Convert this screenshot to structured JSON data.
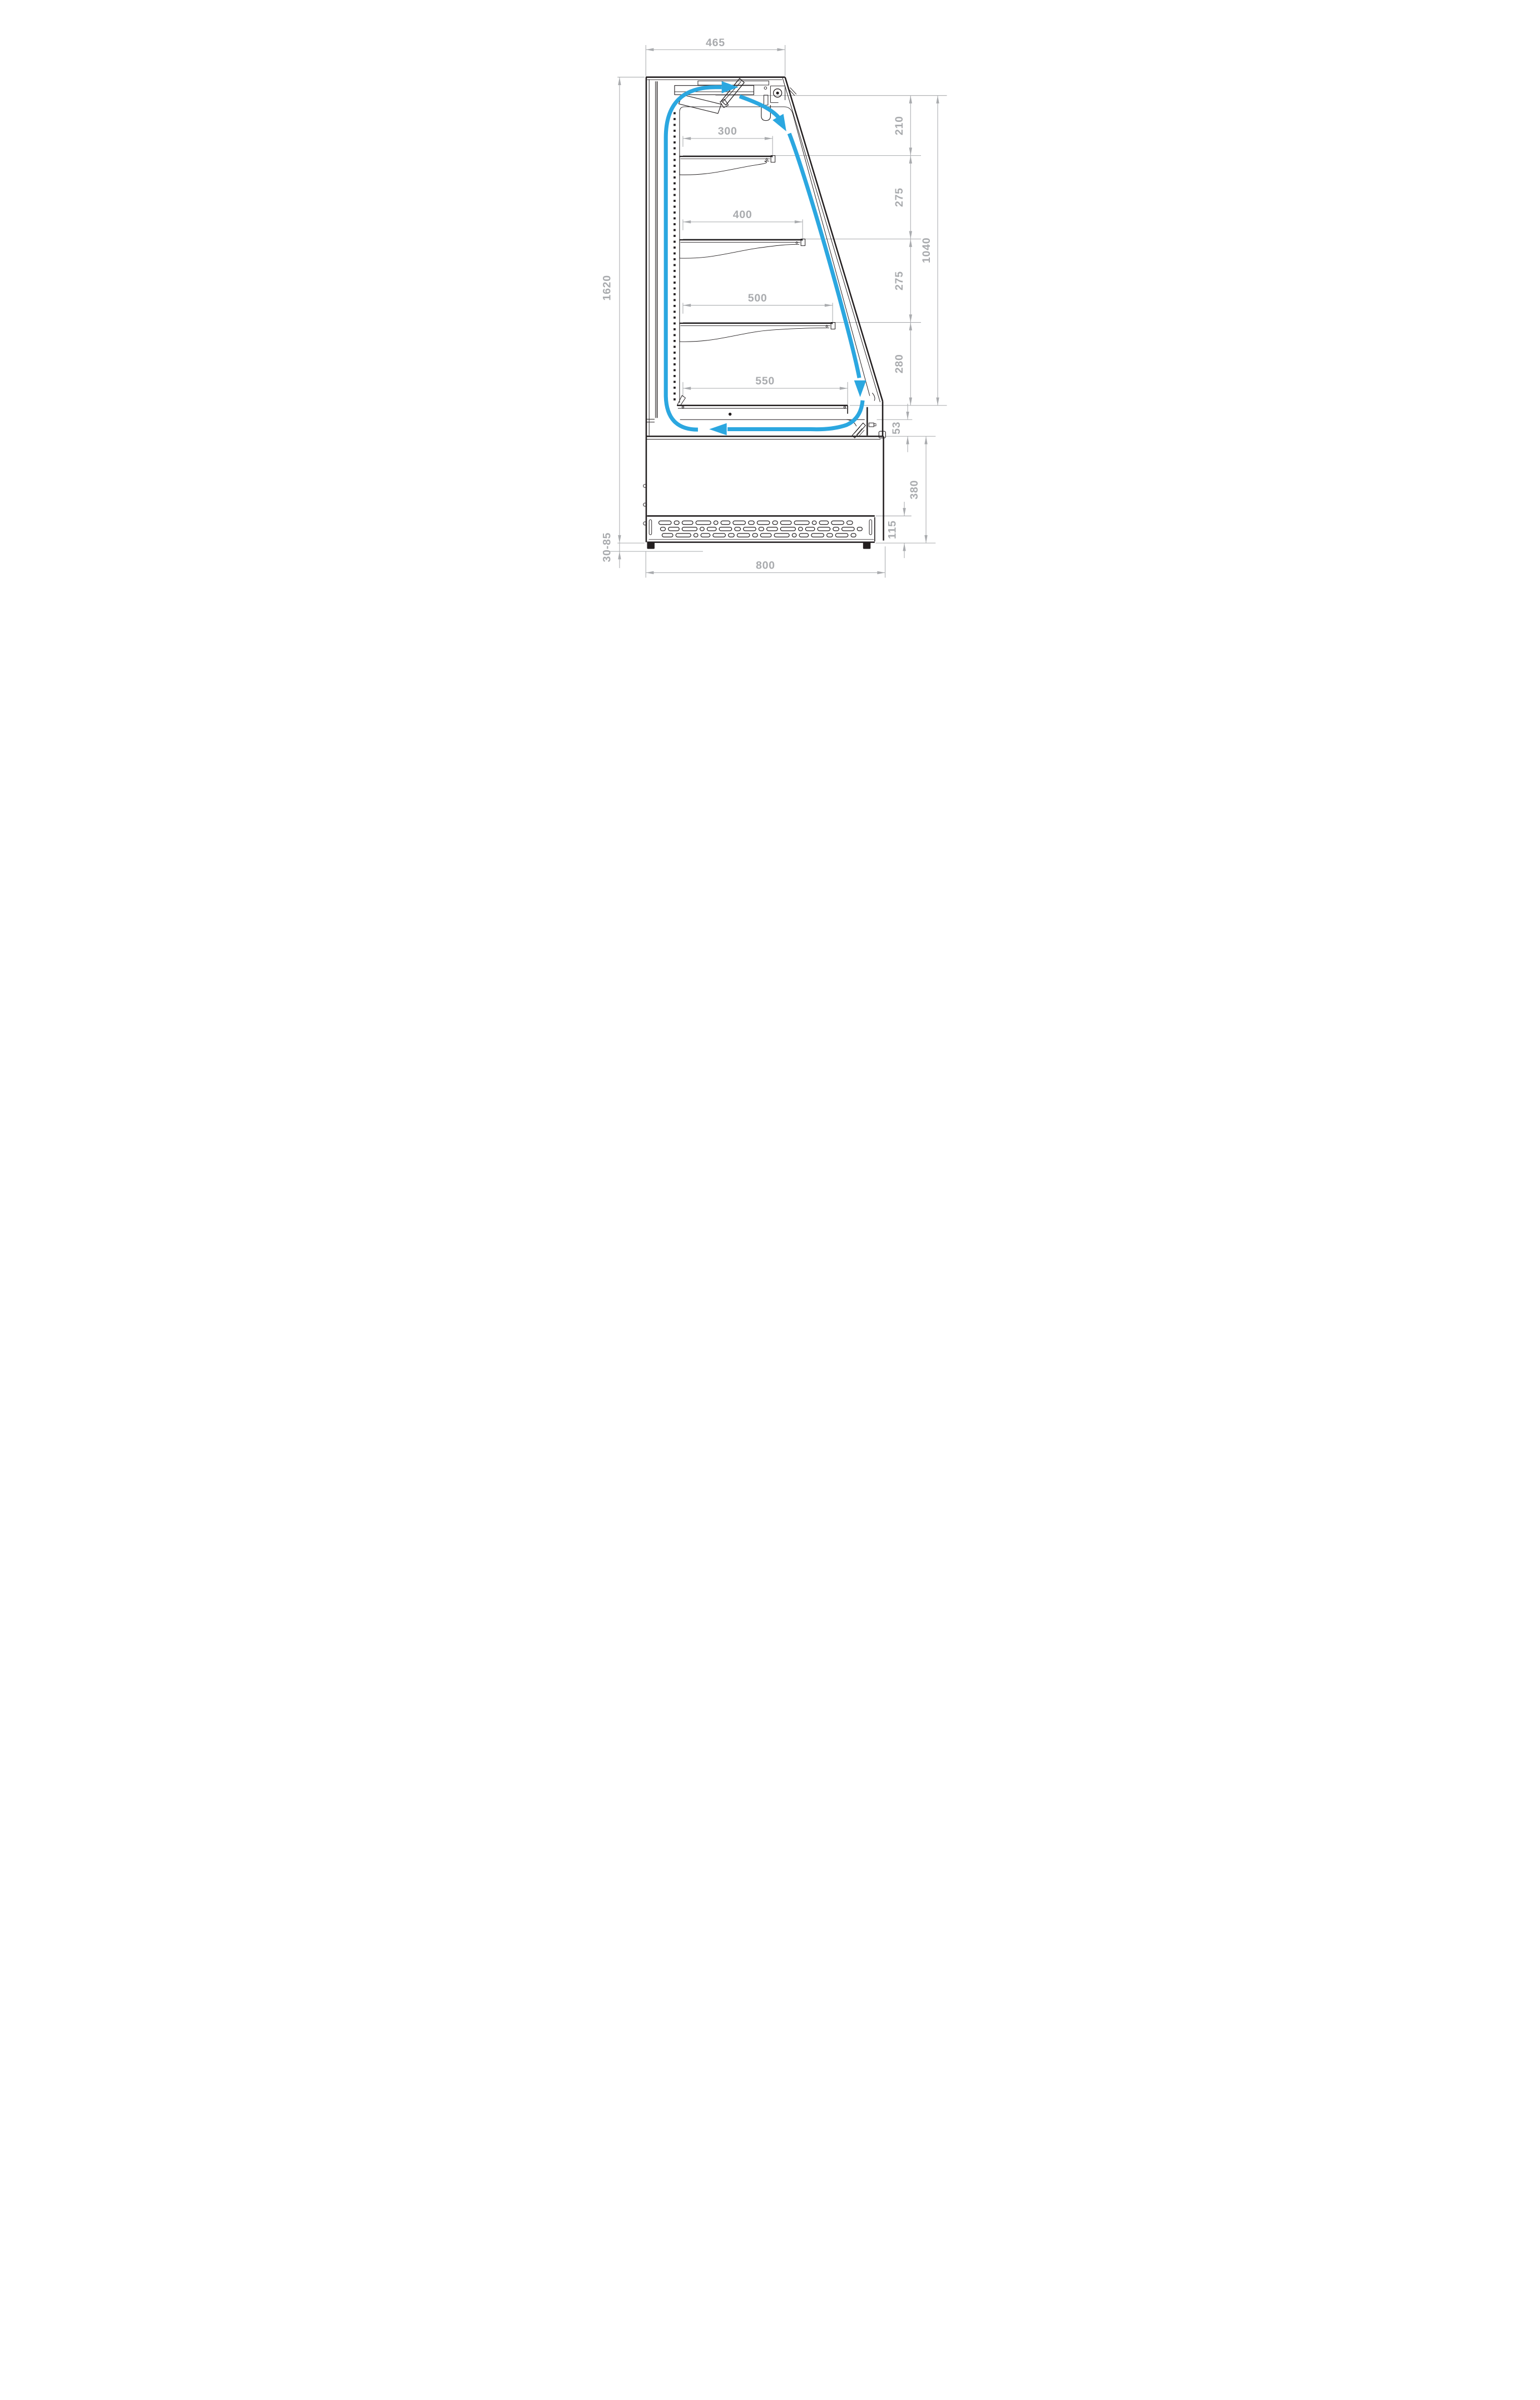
{
  "drawing": {
    "type": "refrigerated-display-case-side-cross-section",
    "dims": {
      "top_depth": "465",
      "shelf1_depth": "300",
      "shelf2_depth": "400",
      "shelf3_depth": "500",
      "deck_depth": "550",
      "gap_top": "210",
      "gap_mid1": "275",
      "gap_mid2": "275",
      "gap_bottom": "280",
      "display_opening_height": "1040",
      "total_height": "1620",
      "return_air_gap": "53",
      "base_height": "380",
      "grille_height": "115",
      "feet_height_range": "30-85",
      "base_width": "800"
    },
    "colors": {
      "line": "#231F20",
      "dimension": "#A9ABAE",
      "airflow": "#2BA7E0",
      "background": "#FFFFFF"
    }
  }
}
